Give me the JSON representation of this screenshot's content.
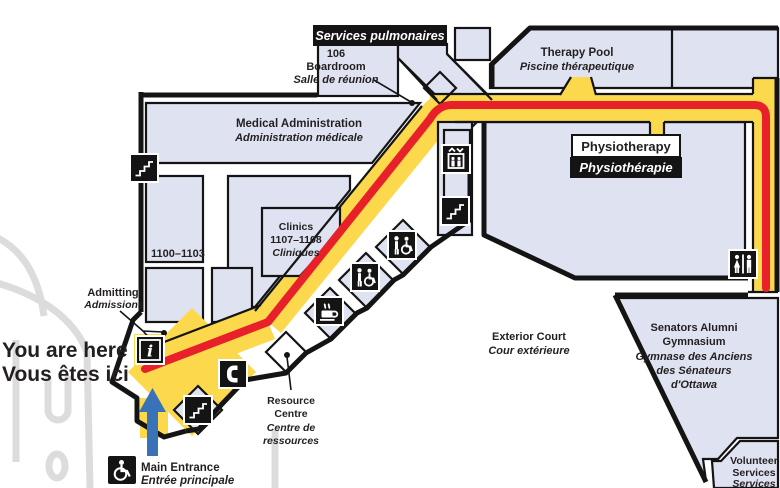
{
  "map": {
    "labels": {
      "services_pulmonaires": "Services pulmonaires",
      "boardroom": {
        "num": "106",
        "en": "Boardroom",
        "fr": "Salle de réunion"
      },
      "therapy_pool": {
        "en": "Therapy Pool",
        "fr": "Piscine thérapeutique"
      },
      "medical_admin": {
        "en": "Medical Administration",
        "fr": "Administration médicale"
      },
      "physiotherapy": {
        "en": "Physiotherapy",
        "fr": "Physiothérapie"
      },
      "clinics": {
        "en": "Clinics",
        "num": "1107–1108",
        "fr": "Cliniques"
      },
      "rooms_1100_1103": "1100–1103",
      "admitting": {
        "en": "Admitting",
        "fr": "Admissions"
      },
      "you_are_here": {
        "en": "You are here",
        "fr": "Vous êtes ici"
      },
      "exterior_court": {
        "en": "Exterior Court",
        "fr": "Cour extérieure"
      },
      "gymnasium": {
        "en1": "Senators Alumni",
        "en2": "Gymnasium",
        "fr1": "Gymnase des Anciens",
        "fr2": "des Sénateurs",
        "fr3": "d'Ottawa"
      },
      "resource_centre": {
        "en1": "Resource",
        "en2": "Centre",
        "fr1": "Centre de",
        "fr2": "ressources"
      },
      "main_entrance": {
        "en": "Main Entrance",
        "fr": "Entrée principale"
      },
      "volunteer_services": {
        "en1": "Volunteer",
        "en2": "Services",
        "fr1": "Services"
      }
    },
    "icons": {
      "stairs": "stairs",
      "elevator": "elevator",
      "accessible_washroom": "accessible-washroom",
      "washroom": "washroom",
      "coffee": "coffee-shop",
      "phone": "telephone",
      "info": "information",
      "wheelchair": "wheelchair-accessible-entrance",
      "info_glyph": "i"
    },
    "colors": {
      "corridor_yellow": "#FBD84C",
      "route_red": "#E8202A",
      "room_fill": "#DFE3F1",
      "wall": "#1A1A1A",
      "elevator_blue": "#2E6CB5",
      "entrance_arrow_blue": "#3A72B8",
      "road_gray": "#DCDCDC",
      "here_text_red": "#E8202A"
    }
  }
}
